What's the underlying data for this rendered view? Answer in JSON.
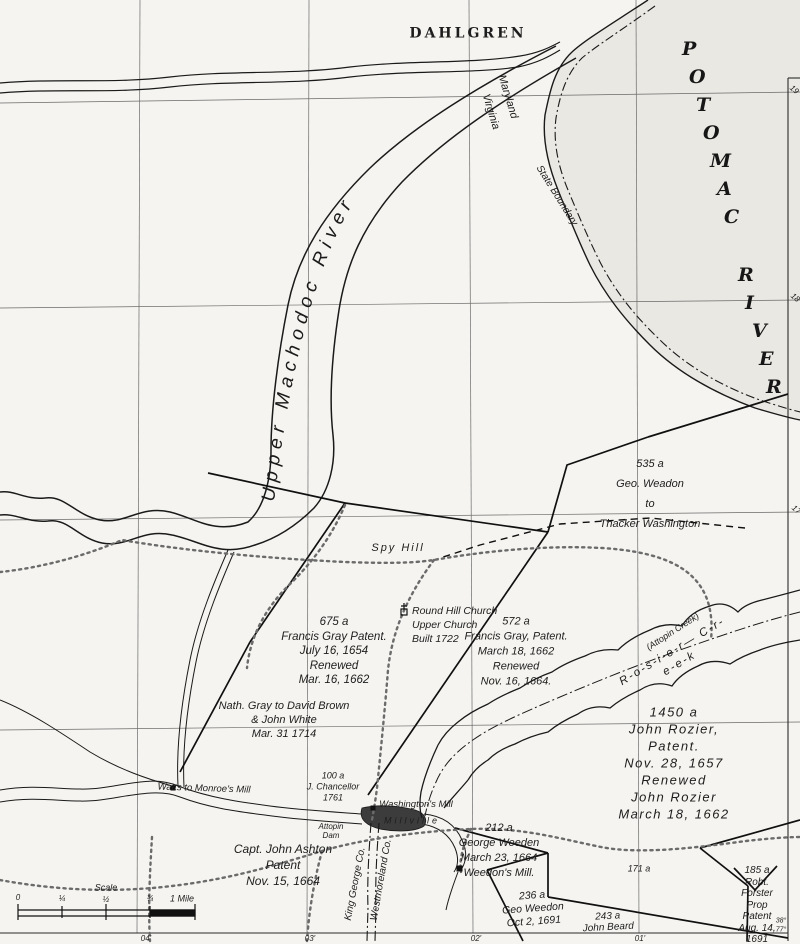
{
  "map": {
    "places": {
      "dahlgren": "DAHLGREN",
      "potomac_river": "POTOMAC RIVER",
      "upper_machodoc_river": "Upper Machodoc River",
      "spy_hill": "Spy Hill",
      "round_hill_church": "Round Hill Church\nUpper Church\nBuilt 1722",
      "rosier_creek": "R-o-s-i-e-r— C-r-e-e-k",
      "attopin_creek": "(Attopin Creek)",
      "watts_monroes_mill": "Watts to Monroe's Mill",
      "washingtons_mill": "Washington's Mill",
      "millville": "Millville",
      "attopin_dam": "Attopin\nDam"
    },
    "boundaries": {
      "maryland": "Maryland",
      "virginia": "Virginia",
      "state_boundary": "State Boundary",
      "king_george_co": "King George Co.",
      "westmoreland_co": "Westmoreland Co."
    },
    "parcels": {
      "weadon_535": "535 a\nGeo. Weadon\nto\nThacker Washington",
      "gray_675": "675 a\nFrancis Gray Patent.\nJuly 16, 1654\nRenewed\nMar. 16, 1662",
      "gray_572": "572 a\nFrancis Gray, Patent.\nMarch 18, 1662\nRenewed\nNov. 16, 1664.",
      "nath_gray": "Nath. Gray to David Brown\n& John White\nMar. 31 1714",
      "rozier_1450": "1450 a\nJohn Rozier, Patent.\nNov. 28, 1657\nRenewed\nJohn Rozier\nMarch 18, 1662",
      "chancellor_100": "100 a\nJ. Chancellor\n1761",
      "weedon_212": "212 a\nGeorge Weeden\nMarch 23, 1664\nWeedon's Mill.",
      "ashton": "Capt. John Ashton\nPatent\nNov. 15, 1664",
      "weedon_236": "236 a\nGeo Weedon\nOct 2, 1691",
      "beard_243": "243 a\nJohn Beard",
      "parcel_171": "171 a",
      "forster_185": "185 a\nRobt. Forster\nProp Patent\nAug. 14, 1691"
    },
    "scale": {
      "label": "Scale",
      "ticks": [
        "0",
        "¼",
        "½",
        "¾"
      ],
      "mile": "1 Mile"
    },
    "graticule": {
      "right": [
        "19",
        "18",
        "17"
      ],
      "bottom": [
        "04'",
        "03'",
        "02'",
        "01'"
      ],
      "corner_lat": "38°",
      "corner_lon": "77°"
    },
    "colors": {
      "paper": "#f5f4f0",
      "water": "#eae8e3",
      "ink": "#1a1a1a",
      "road_dots": "#6b6b6b"
    }
  }
}
